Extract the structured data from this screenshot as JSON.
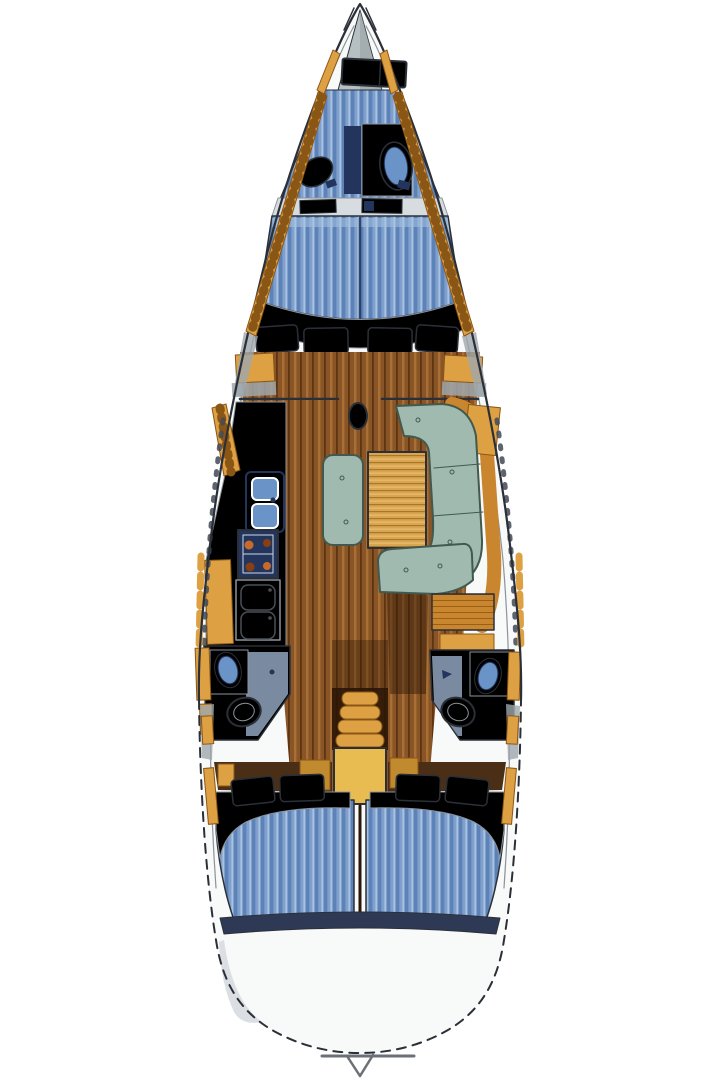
{
  "diagram": {
    "title": "Sailing yacht interior layout — top-down floor plan, bow at top, stern at bottom"
  },
  "palette": {
    "ink": "#2b3038",
    "deck": "#f8f9f9",
    "deck_shadow": "#d7dce0",
    "anchor": "#b6bfc2",
    "anchor_dark": "#9ca6a9",
    "stripe_base": "#7fa0cc",
    "stripe_dark": "#5d82b8",
    "stripe_light": "#a8c2e0",
    "wood": "#8a5526",
    "wood_dark": "#5e3413",
    "wood_light": "#a96f36",
    "gold": "#dda143",
    "gold_bright": "#e9bc52",
    "gold_deep": "#8a5616",
    "tan": "#c9862e",
    "tan_dark": "#9a5f16",
    "table_wood": "#d9a54e",
    "table_dark": "#a9762a",
    "table_light": "#e9c078",
    "green": "#a0bab0",
    "green_ink": "#42594f",
    "navy": "#23355c",
    "sink_blue": "#6a94c8",
    "floor_blue": "#8fa3bd",
    "band_navy": "#2e3a55",
    "band_brown": "#4a2f16",
    "shadow_brown": "#2a1606",
    "burner": "#c96a2a",
    "burner_dark": "#8a3f12",
    "grey_wedge": "#9fa8ad",
    "line_grey": "#8b939b"
  },
  "areas": {
    "boat": {
      "label": "Sailing yacht interior floor plan"
    },
    "hull": {
      "label": "Hull outline"
    },
    "bow_fitting": {
      "label": "Bow fitting and forestay"
    },
    "anchor_locker": {
      "label": "Anchor locker"
    },
    "foredeck_hatch": {
      "label": "Foredeck hatch"
    },
    "toe_rail_port": {
      "label": "Port side rail"
    },
    "toe_rail_starboard": {
      "label": "Starboard side rail"
    },
    "bow_cabin_berth": {
      "label": "Bow cabin berth"
    },
    "bow_cabin_sink": {
      "label": "Bow cabin wash basin"
    },
    "bow_cabin_basin": {
      "label": "Bow cabin oval basin"
    },
    "bow_cabin_locker": {
      "label": "Bow cabin locker"
    },
    "bulkhead_shelf": {
      "label": "Forward bulkhead shelf"
    },
    "v_berth": {
      "label": "Forward cabin V-berth"
    },
    "v_berth_foot": {
      "label": "V-berth foot surround"
    },
    "v_berth_cushions": {
      "label": "Forward cabin seat cushions"
    },
    "wardrobe_port": {
      "label": "Port wardrobe locker"
    },
    "wardrobe_starboard": {
      "label": "Starboard wardrobe locker"
    },
    "mast_step": {
      "label": "Mast step"
    },
    "saloon_sole": {
      "label": "Saloon wood sole"
    },
    "galley": {
      "label": "Galley"
    },
    "galley_shelf": {
      "label": "Galley outboard shelf"
    },
    "galley_sink": {
      "label": "Galley double sink"
    },
    "galley_stove": {
      "label": "Galley stove"
    },
    "galley_fridge": {
      "label": "Galley refrigerator lockers"
    },
    "galley_locker": {
      "label": "Galley side locker"
    },
    "saloon_table": {
      "label": "Saloon table"
    },
    "settee_u": {
      "label": "U-shaped settee"
    },
    "settee_center": {
      "label": "Centerline settee"
    },
    "settee_aft": {
      "label": "Aft settee bench"
    },
    "sideboard": {
      "label": "Starboard sideboard shelf"
    },
    "nav_table": {
      "label": "Chart table"
    },
    "nav_locker": {
      "label": "Chart table locker"
    },
    "port_head": {
      "label": "Port head compartment"
    },
    "port_head_sink": {
      "label": "Port head sink"
    },
    "port_head_toilet": {
      "label": "Port head toilet"
    },
    "starboard_head": {
      "label": "Starboard head compartment"
    },
    "starboard_head_sink": {
      "label": "Starboard head sink"
    },
    "starboard_head_toilet": {
      "label": "Starboard head toilet"
    },
    "companionway": {
      "label": "Companionway steps"
    },
    "engine_box": {
      "label": "Engine box under companionway"
    },
    "aft_berth_port": {
      "label": "Port aft cabin double berth"
    },
    "aft_berth_port_pillows": {
      "label": "Port aft cabin pillows"
    },
    "aft_berth_starboard": {
      "label": "Starboard aft cabin double berth"
    },
    "aft_berth_starboard_pillows": {
      "label": "Starboard aft cabin pillows"
    },
    "transom": {
      "label": "Transom and aft deck"
    },
    "swim_notch": {
      "label": "Transom notch"
    }
  }
}
